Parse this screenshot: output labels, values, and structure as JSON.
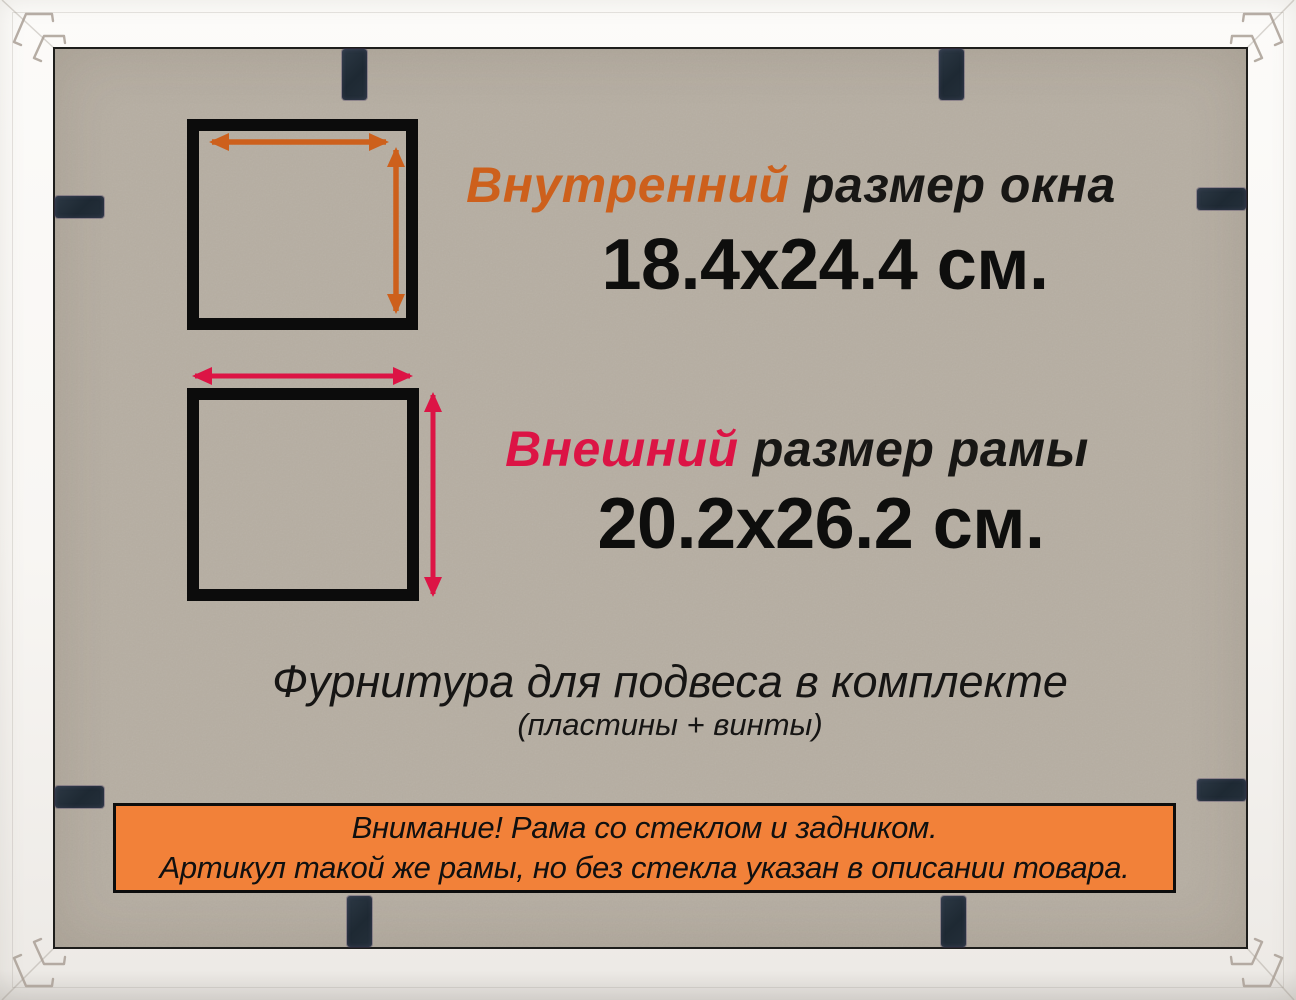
{
  "image_type": "product photo of picture frame back with size diagram",
  "colors": {
    "inner_accent": "#cd601c",
    "outer_accent": "#dc1445",
    "banner_background": "#f28139",
    "backing_board": "#b6aea2",
    "frame_white": "#f8f6f3",
    "clip_metal": "#232e38",
    "square_outline": "#0c0c0c"
  },
  "icons": {
    "inner_width_arrow": "double-headed-horizontal-arrow",
    "inner_height_arrow": "double-headed-vertical-arrow",
    "outer_width_arrow": "double-headed-horizontal-arrow",
    "outer_height_arrow": "double-headed-vertical-arrow",
    "corner_bracket": "metal-corner-hanger",
    "clip": "metal-retainer-tab"
  },
  "inner_size": {
    "label_highlight": "Внутренний",
    "label_rest": " размер окна",
    "value": "18.4х24.4 см."
  },
  "outer_size": {
    "label_highlight": "Внешний",
    "label_rest": " размер рамы",
    "value": "20.2х26.2 см."
  },
  "hardware": {
    "line1": "Фурнитура для подвеса в комплекте",
    "line2": "(пластины + винты)"
  },
  "notice": {
    "line1": "Внимание! Рама со стеклом и задником.",
    "line2": "Артикул такой же рамы, но без стекла указан в описании товара."
  }
}
